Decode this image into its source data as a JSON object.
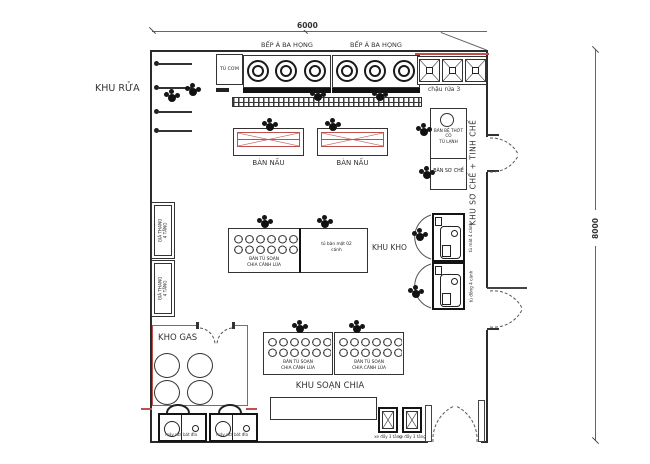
{
  "meta": {
    "accent_red": "#c0504d",
    "line_color": "#2b2b2b"
  },
  "dimensions": {
    "top": "6000",
    "right": "8000"
  },
  "zones": {
    "washing": "KHU RỬA",
    "prep_zone": "KHU SƠ CHẾ + TINH CHẾ",
    "storage": "KHU KHO",
    "gas": "KHO GAS",
    "plating": "KHU SOẠN CHIA"
  },
  "equipment": {
    "rice_steamer": "TỦ CƠM",
    "asian_range_1": "BẾP Á BA HỌNG",
    "asian_range_2": "BẾP Á BA HỌNG",
    "triple_sink": "chậu rửa 3",
    "cook_table_1": "BÀN NẤU",
    "cook_table_2": "BÀN NẤU",
    "board_table_line1": "BÀN BỆ THỚT CÓ",
    "board_table_line2": "TỦ LẠNH",
    "raw_prep_table": "BÀN SƠ CHẾ",
    "rack_line1": "GIÁ THANG",
    "rack_line2": "4 TẦNG",
    "cooler_4door": "tủ mát 4 cánh",
    "freezer_4door": "tủ đông 4 cánh",
    "serve_cabinet_line1": "BÀN TỦ SOẠN",
    "serve_cabinet_line2": "CHIA CÁNH LÙA",
    "two_door_cabinet_line1": "tủ bàn mặt 02",
    "two_door_cabinet_line2": "cánh",
    "dishwasher_1": "máy rửa bát đĩa",
    "dishwasher_2": "máy rửa bát đĩa",
    "cart_1": "xe đẩy 3 tầng",
    "cart_2": "xe đẩy 3 tầng"
  }
}
